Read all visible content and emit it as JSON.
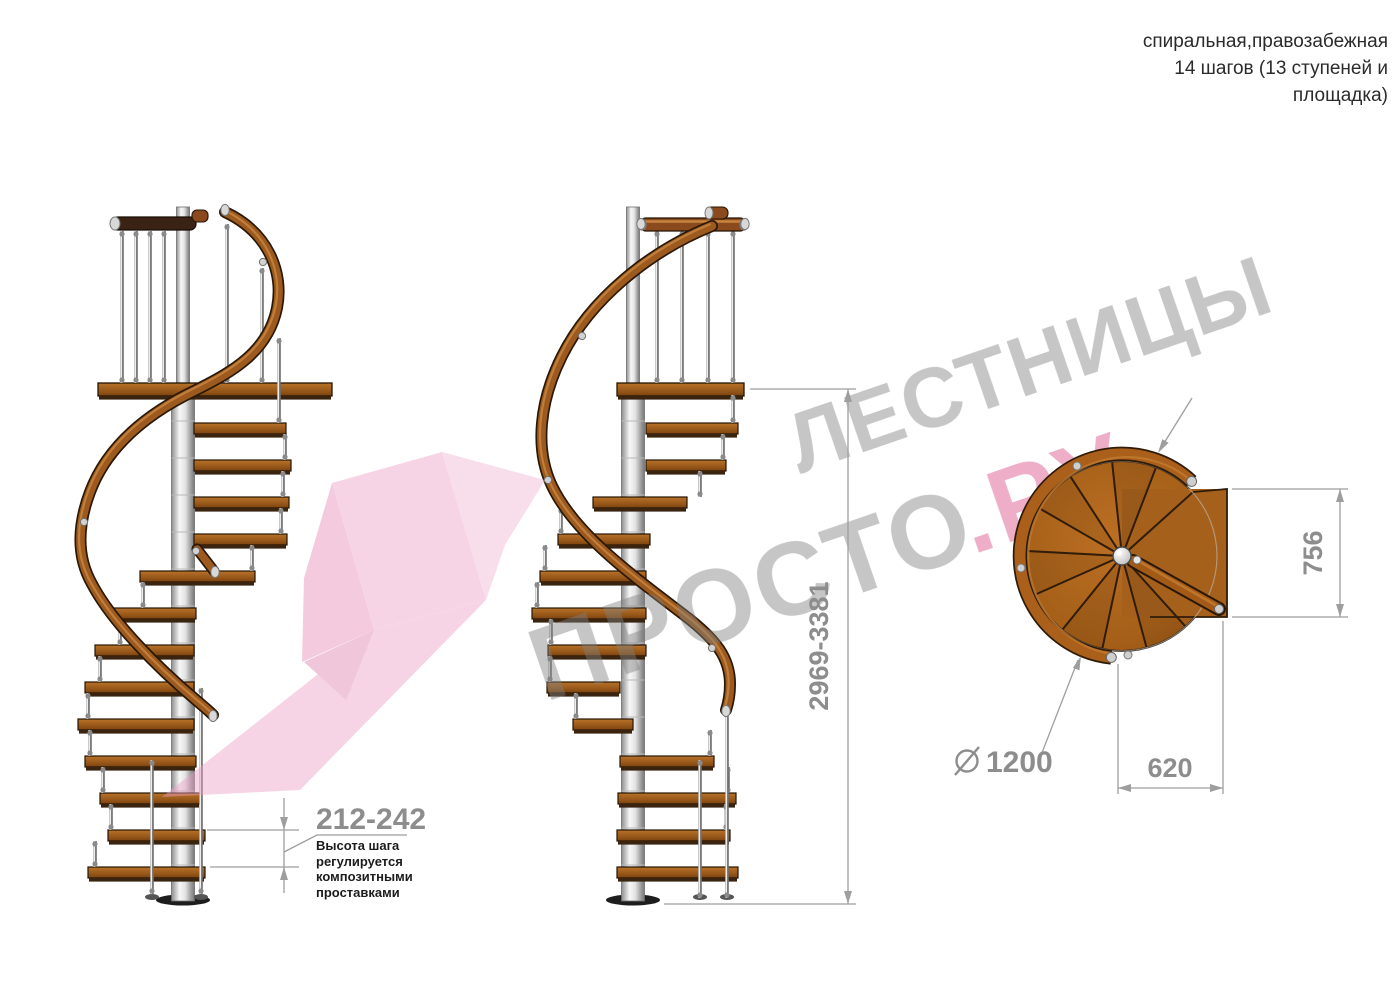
{
  "header": {
    "title_lines": [
      "спиральная,правозабежная",
      "14 шагов (13 ступеней и",
      "площадка)"
    ]
  },
  "watermark": {
    "word1": "ЛЕСТНИЦЫ",
    "word2": "ПРОСТО",
    "word2_suffix": ".РУ"
  },
  "annotations": {
    "step_height": {
      "value": "212-242",
      "note_lines": [
        "Высота шага",
        "регулируется",
        "композитными",
        "проставками"
      ]
    },
    "total_height": {
      "value": "2969-3381"
    },
    "plan_depth": {
      "value": "756"
    },
    "plan_width": {
      "value": "620"
    },
    "plan_diameter": {
      "value": "1200",
      "symbol": "⌀"
    }
  },
  "colors": {
    "wood": "#a5601c",
    "rail_wood": "#9c5a1e",
    "dark_rail": "#3a2315",
    "dimension_gray": "#8d8d8d",
    "line_gray": "#9e9e9e",
    "ink": "#2b2b2b",
    "watermark_gray": "#808080",
    "watermark_pink": "#d84b85",
    "logo_pink": "#ec9fc4"
  }
}
